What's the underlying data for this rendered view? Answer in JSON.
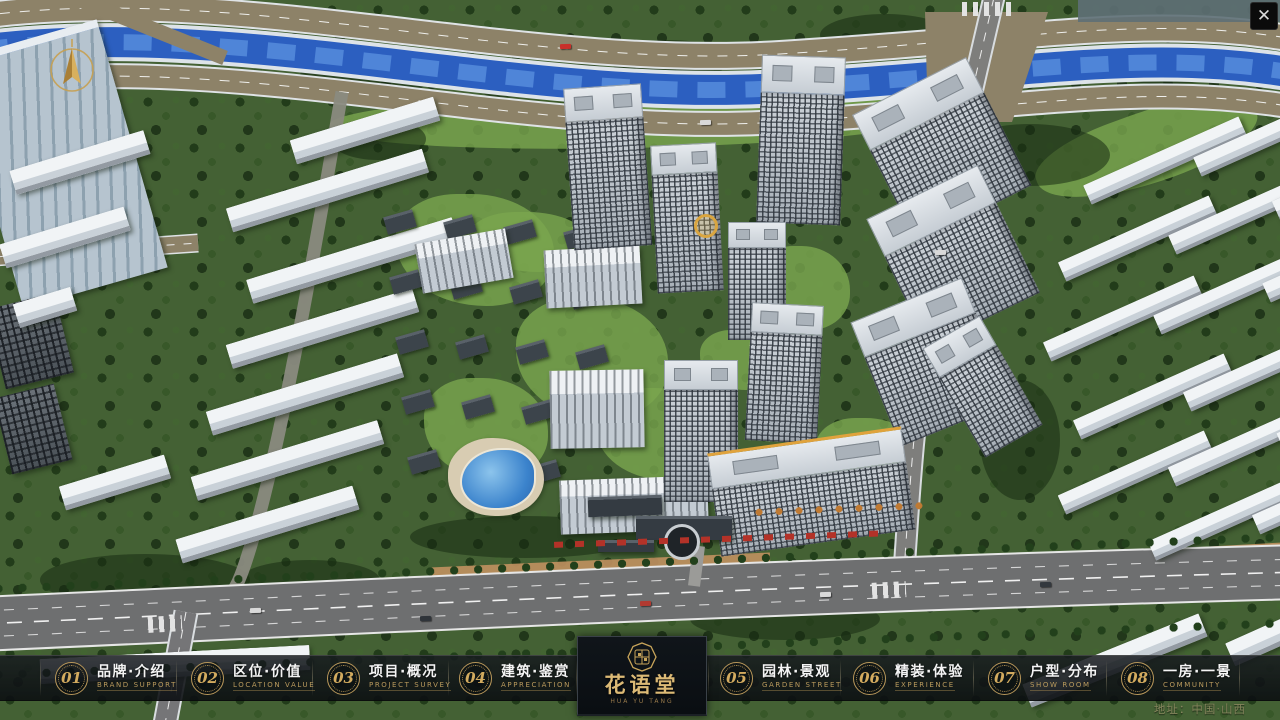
{
  "window": {
    "close_glyph": "✕"
  },
  "navbar": {
    "items": [
      {
        "num": "01",
        "zh": "品牌·介绍",
        "en": "BRAND SUPPORT"
      },
      {
        "num": "02",
        "zh": "区位·价值",
        "en": "LOCATION VALUE"
      },
      {
        "num": "03",
        "zh": "项目·概况",
        "en": "PROJECT SURVEY"
      },
      {
        "num": "04",
        "zh": "建筑·鉴赏",
        "en": "APPRECIATION"
      },
      {
        "num": "05",
        "zh": "园林·景观",
        "en": "GARDEN STREET"
      },
      {
        "num": "06",
        "zh": "精装·体验",
        "en": "EXPERIENCE"
      },
      {
        "num": "07",
        "zh": "户型·分布",
        "en": "SHOW ROOM"
      },
      {
        "num": "08",
        "zh": "一房·一景",
        "en": "COMMUNITY"
      }
    ]
  },
  "logo": {
    "name": "花语堂",
    "sub": "HUA YU TANG"
  },
  "footer": {
    "address": "地址：中国·山西"
  },
  "colors": {
    "gold": "#c9a55a",
    "bar_bg": "#12161a",
    "river": "#2c5fc0",
    "road": "#8d8268"
  }
}
